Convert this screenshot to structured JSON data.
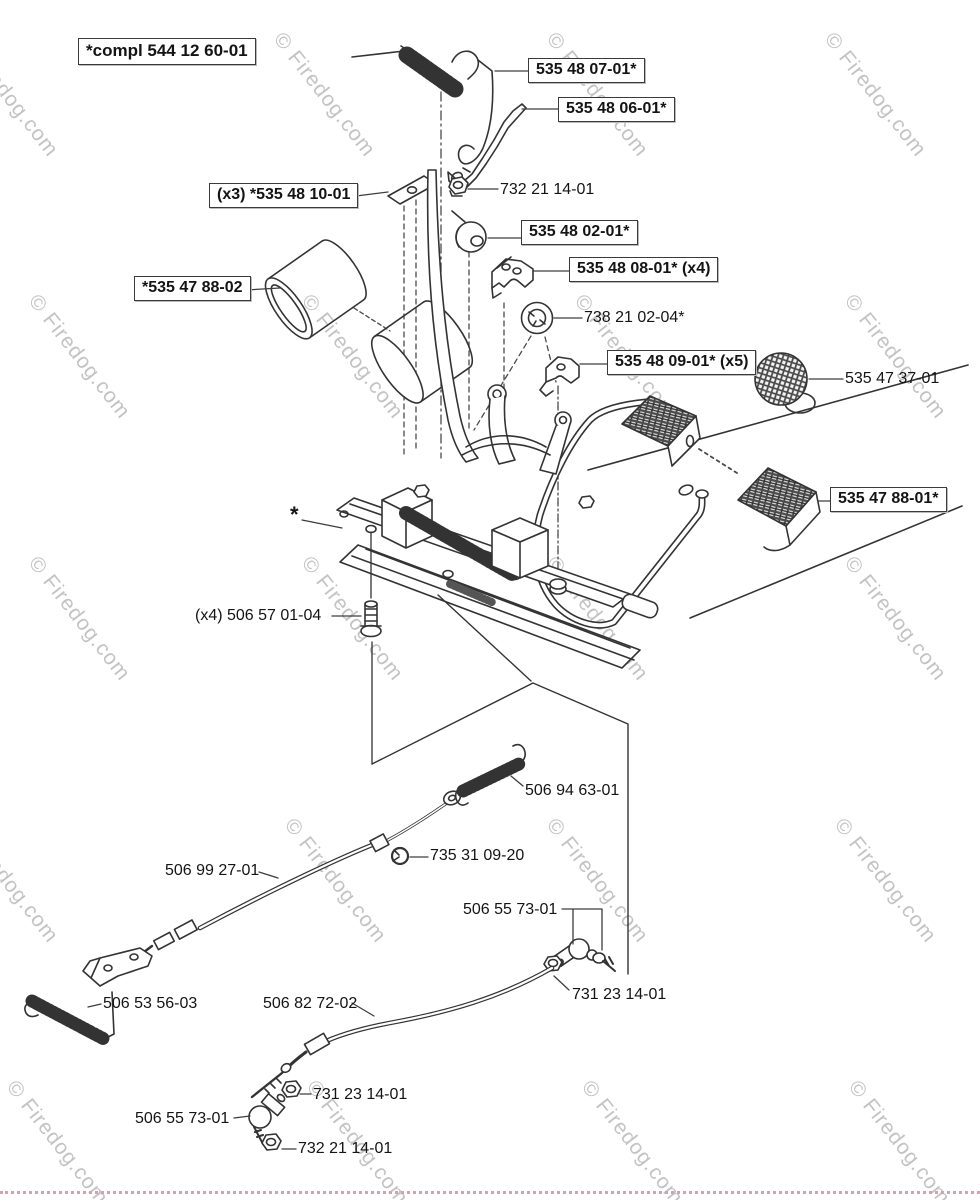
{
  "site": {
    "watermark": "© Firedog.com"
  },
  "diagram": {
    "labels": [
      {
        "id": "compl",
        "text": "*compl 544 12 60-01",
        "boxed": true
      },
      {
        "id": "p5354807",
        "text": "535 48 07-01*",
        "boxed": true
      },
      {
        "id": "p5354806",
        "text": "535 48 06-01*",
        "boxed": true
      },
      {
        "id": "p5354810",
        "text": "(x3) *535 48 10-01",
        "boxed": true
      },
      {
        "id": "p7322114top",
        "text": "732 21 14-01",
        "boxed": false
      },
      {
        "id": "p5354802",
        "text": "535 48 02-01*",
        "boxed": true
      },
      {
        "id": "p5354808",
        "text": "535 48 08-01* (x4)",
        "boxed": true
      },
      {
        "id": "p7382102",
        "text": "738 21 02-04*",
        "boxed": false
      },
      {
        "id": "p5354788_02",
        "text": "*535 47 88-02",
        "boxed": true
      },
      {
        "id": "p5354809",
        "text": "535 48 09-01* (x5)",
        "boxed": true
      },
      {
        "id": "p5354737",
        "text": "535 47 37-01",
        "boxed": false
      },
      {
        "id": "p5354788_01",
        "text": "535 47 88-01*",
        "boxed": true
      },
      {
        "id": "asterisk",
        "text": "*",
        "boxed": false
      },
      {
        "id": "p5065701",
        "text": "(x4) 506 57 01-04",
        "boxed": false
      },
      {
        "id": "p5069463",
        "text": "506 94 63-01",
        "boxed": false
      },
      {
        "id": "p7353109",
        "text": "735 31 09-20",
        "boxed": false
      },
      {
        "id": "p5069927",
        "text": "506 99 27-01",
        "boxed": false
      },
      {
        "id": "p5065573u",
        "text": "506 55 73-01",
        "boxed": false
      },
      {
        "id": "p7312314u",
        "text": "731 23 14-01",
        "boxed": false
      },
      {
        "id": "p5065356",
        "text": "506 53 56-03",
        "boxed": false
      },
      {
        "id": "p5068272",
        "text": "506 82 72-02",
        "boxed": false
      },
      {
        "id": "p7312314l",
        "text": "731 23 14-01",
        "boxed": false
      },
      {
        "id": "p5065573l",
        "text": "506 55 73-01",
        "boxed": false
      },
      {
        "id": "p7322114l",
        "text": "732 21 14-01",
        "boxed": false
      }
    ]
  }
}
